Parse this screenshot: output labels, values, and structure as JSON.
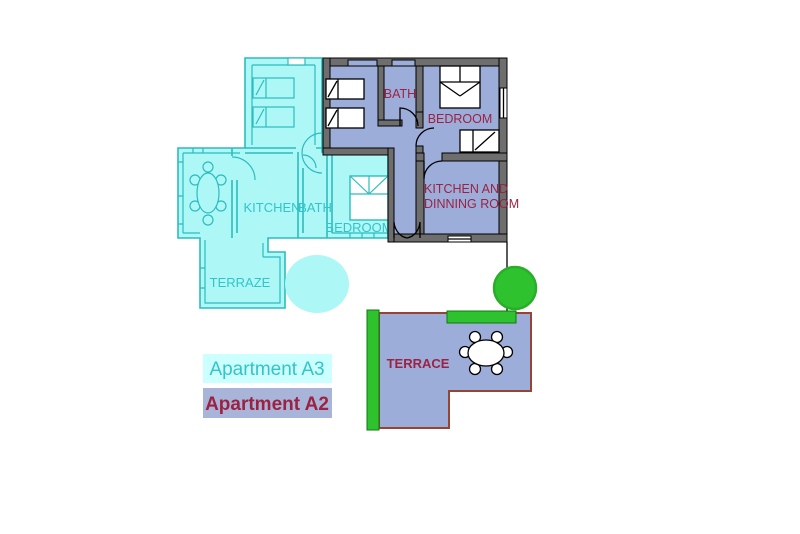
{
  "colors": {
    "background": "#FFFFFF",
    "a3_fill": "#AEF7F7",
    "a3_line": "#2CBCBE",
    "a3_label": "#33C4C8",
    "a2_fill": "#9DADD9",
    "wall_gray": "#6E6E6E",
    "wall_edge": "#000000",
    "a2_label": "#9B2242",
    "terrace_border": "#994433",
    "green": "#2EC32E",
    "legend_a3_bg": "#CCFFFF",
    "legend_a2_bg": "#A9B4D9",
    "bed_fill": "#FFFFFF"
  },
  "apartment_a3": {
    "rooms": {
      "kitchen": "KITCHEN",
      "bath": "BATH",
      "bedroom": "BEDROOM",
      "terrace": "TERRAZE"
    }
  },
  "apartment_a2": {
    "rooms": {
      "bath": "BATH",
      "bedroom": "BEDROOM",
      "kitchen_line1": "KITCHEN AND",
      "kitchen_line2": "DINNING ROOM",
      "terrace": "TERRACE"
    }
  },
  "legend": {
    "a3": "Apartment A3",
    "a2": "Apartment A2"
  },
  "icons": {
    "single_bed": "bed-icon",
    "double_bed": "double-bed-icon",
    "dining_table": "dining-table-icon",
    "terrace_table": "terrace-table-icon",
    "door": "door-arc-icon",
    "window": "window-icon",
    "tree": "tree-icon",
    "planter": "planter-bar-icon"
  }
}
